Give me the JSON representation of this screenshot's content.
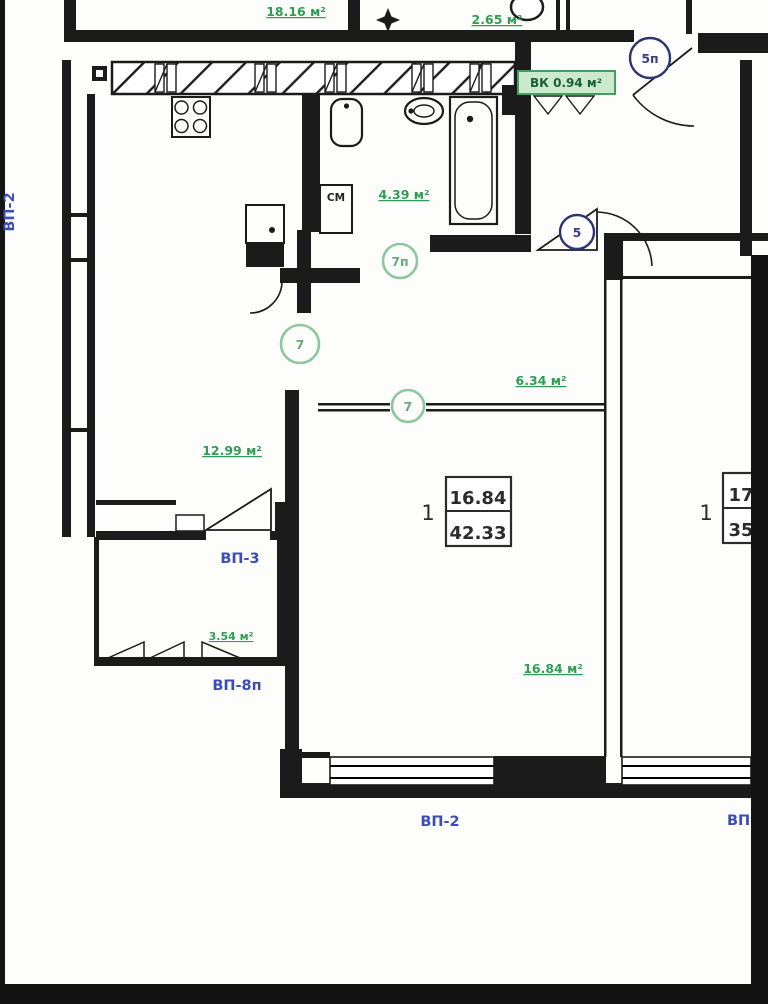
{
  "colors": {
    "wall": "#1b1b1b",
    "area_label_green": "#2f9e54",
    "highlight_green_bg": "#cde9cd",
    "highlight_green_border": "#41a05f",
    "window_label_blue": "#3d4db7",
    "door_marker_blue": "#2e3470",
    "door_marker_green": "#7fbf95"
  },
  "areas": {
    "upper_room": "18.16 м²",
    "upper_small": "2.65 м²",
    "vent_chamber": "ВК 0.94 м²",
    "bathroom": "4.39 м²",
    "hallway": "6.34 м²",
    "kitchen": "12.99 м²",
    "balcony": "3.54 м²",
    "living_room": "16.84 м²"
  },
  "door_markers": {
    "upper_entry": "5п",
    "entry": "5",
    "bathroom": "7п",
    "kitchen": "7",
    "living": "7"
  },
  "unit_tags": {
    "left": {
      "rooms": "1",
      "living_area": "16.84",
      "total_area": "42.33"
    },
    "right": {
      "rooms": "1",
      "living_area": "17",
      "total_area": "35"
    }
  },
  "window_labels": {
    "left_vertical": "ВП-2",
    "balcony_inner": "ВП-3",
    "balcony_outer": "ВП-8п",
    "bottom_center": "ВП-2",
    "bottom_right": "ВП-"
  },
  "appliances": {
    "washing_machine": "СМ"
  }
}
